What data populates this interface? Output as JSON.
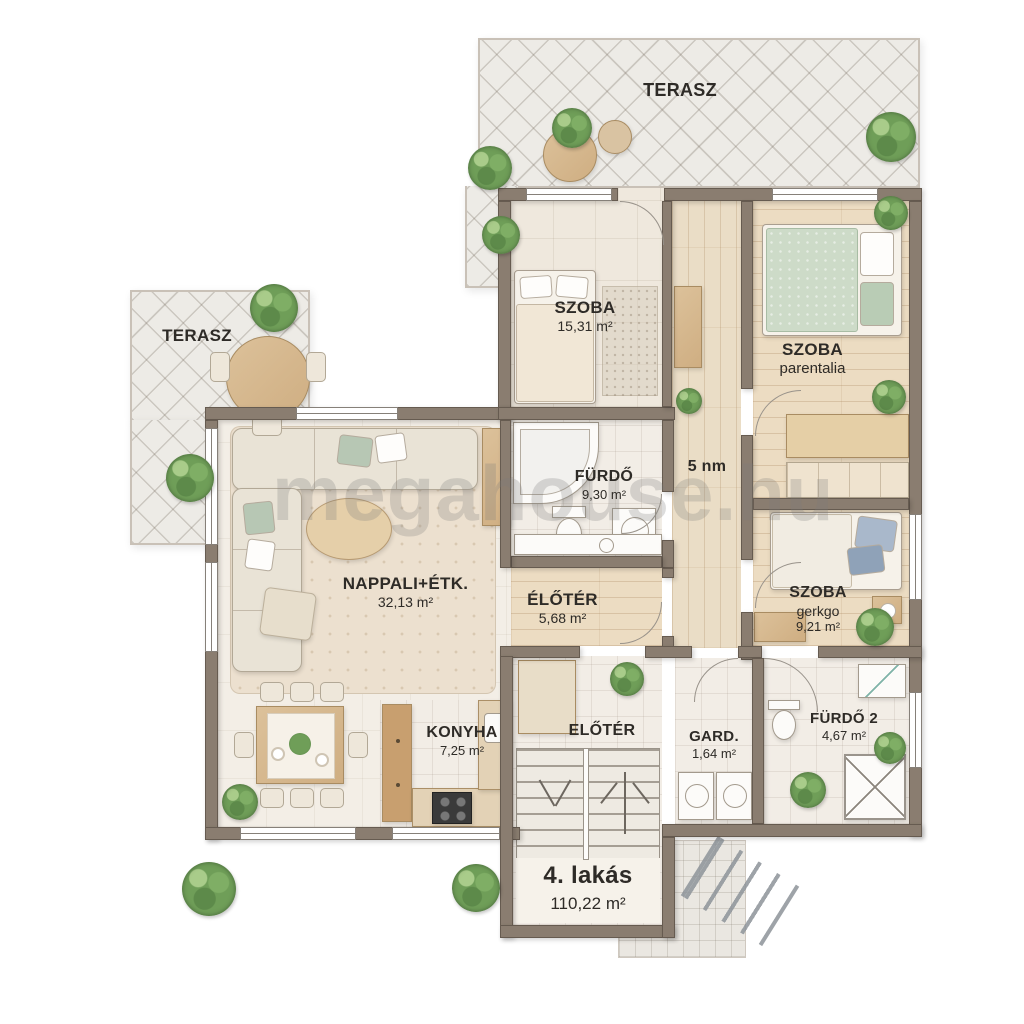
{
  "watermark": "megahouse.hu",
  "title_block": {
    "name": "4. lakás",
    "area": "110,22 m²"
  },
  "terraces": {
    "top_label": "TERASZ",
    "left_label": "TERASZ"
  },
  "rooms": {
    "szoba1": {
      "name": "SZOBA",
      "area": "15,31 m²"
    },
    "szoba_parentalia": {
      "name": "SZOBA",
      "subtitle": "parentalia"
    },
    "furdo1": {
      "name": "FÜRDŐ",
      "area": "9,30 m²"
    },
    "hall": {
      "label": "5 nm"
    },
    "nappali": {
      "name": "NAPPALI+ÉTK.",
      "area": "32,13 m²"
    },
    "eloter1": {
      "name": "ÉLŐTÉR",
      "area": "5,68 m²"
    },
    "szoba_gerkgo": {
      "name": "SZOBA",
      "subtitle": "gerkgo",
      "area": "9,21 m²"
    },
    "konyha": {
      "name": "KONYHA",
      "area": "7,25 m²"
    },
    "eloter2": {
      "name": "ELŐTÉR"
    },
    "gard": {
      "name": "GARD.",
      "area": "1,64 m²"
    },
    "furdo2": {
      "name": "FÜRDŐ 2",
      "area": "4,67 m²"
    }
  },
  "colors": {
    "wall": "#8a7d70",
    "terrace_tile": "#edebe6",
    "wood_floor": "#ecdcc2",
    "accent_green": "#b7c7b4",
    "label_text": "#2e2b27"
  }
}
